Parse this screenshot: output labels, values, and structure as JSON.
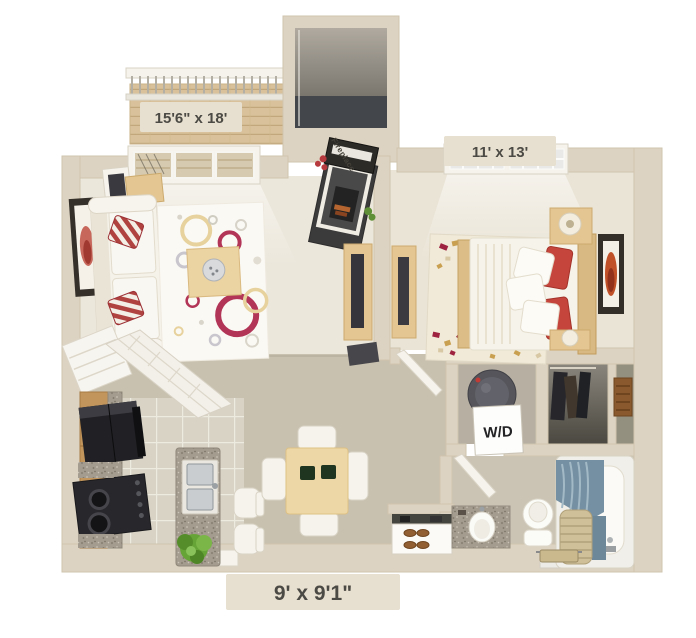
{
  "labels": {
    "living_room_dims": "15'6\" x 18'",
    "bedroom_dims": "11' x 13'",
    "kitchen_dims": "9' x 9'1\"",
    "fireplace": "Fireplace",
    "washer_dryer": "W/D"
  },
  "colors": {
    "background": "#ffffff",
    "wall": "#ddd3c2",
    "living_carpet": "#ece7db",
    "bedroom_carpet": "#eae4d6",
    "hall_floor": "#c8c1af",
    "kitchen_tile": "#d8d3c5",
    "accent_red": "#b23456",
    "pillow_red": "#c4423a",
    "wood_light": "#e3c692",
    "cabinet_wood": "#c2955c",
    "appliance_black": "#232327",
    "curtain_blue": "#7590a3",
    "label_text": "#4c4a44",
    "label_chip": "#e7dfcf"
  }
}
